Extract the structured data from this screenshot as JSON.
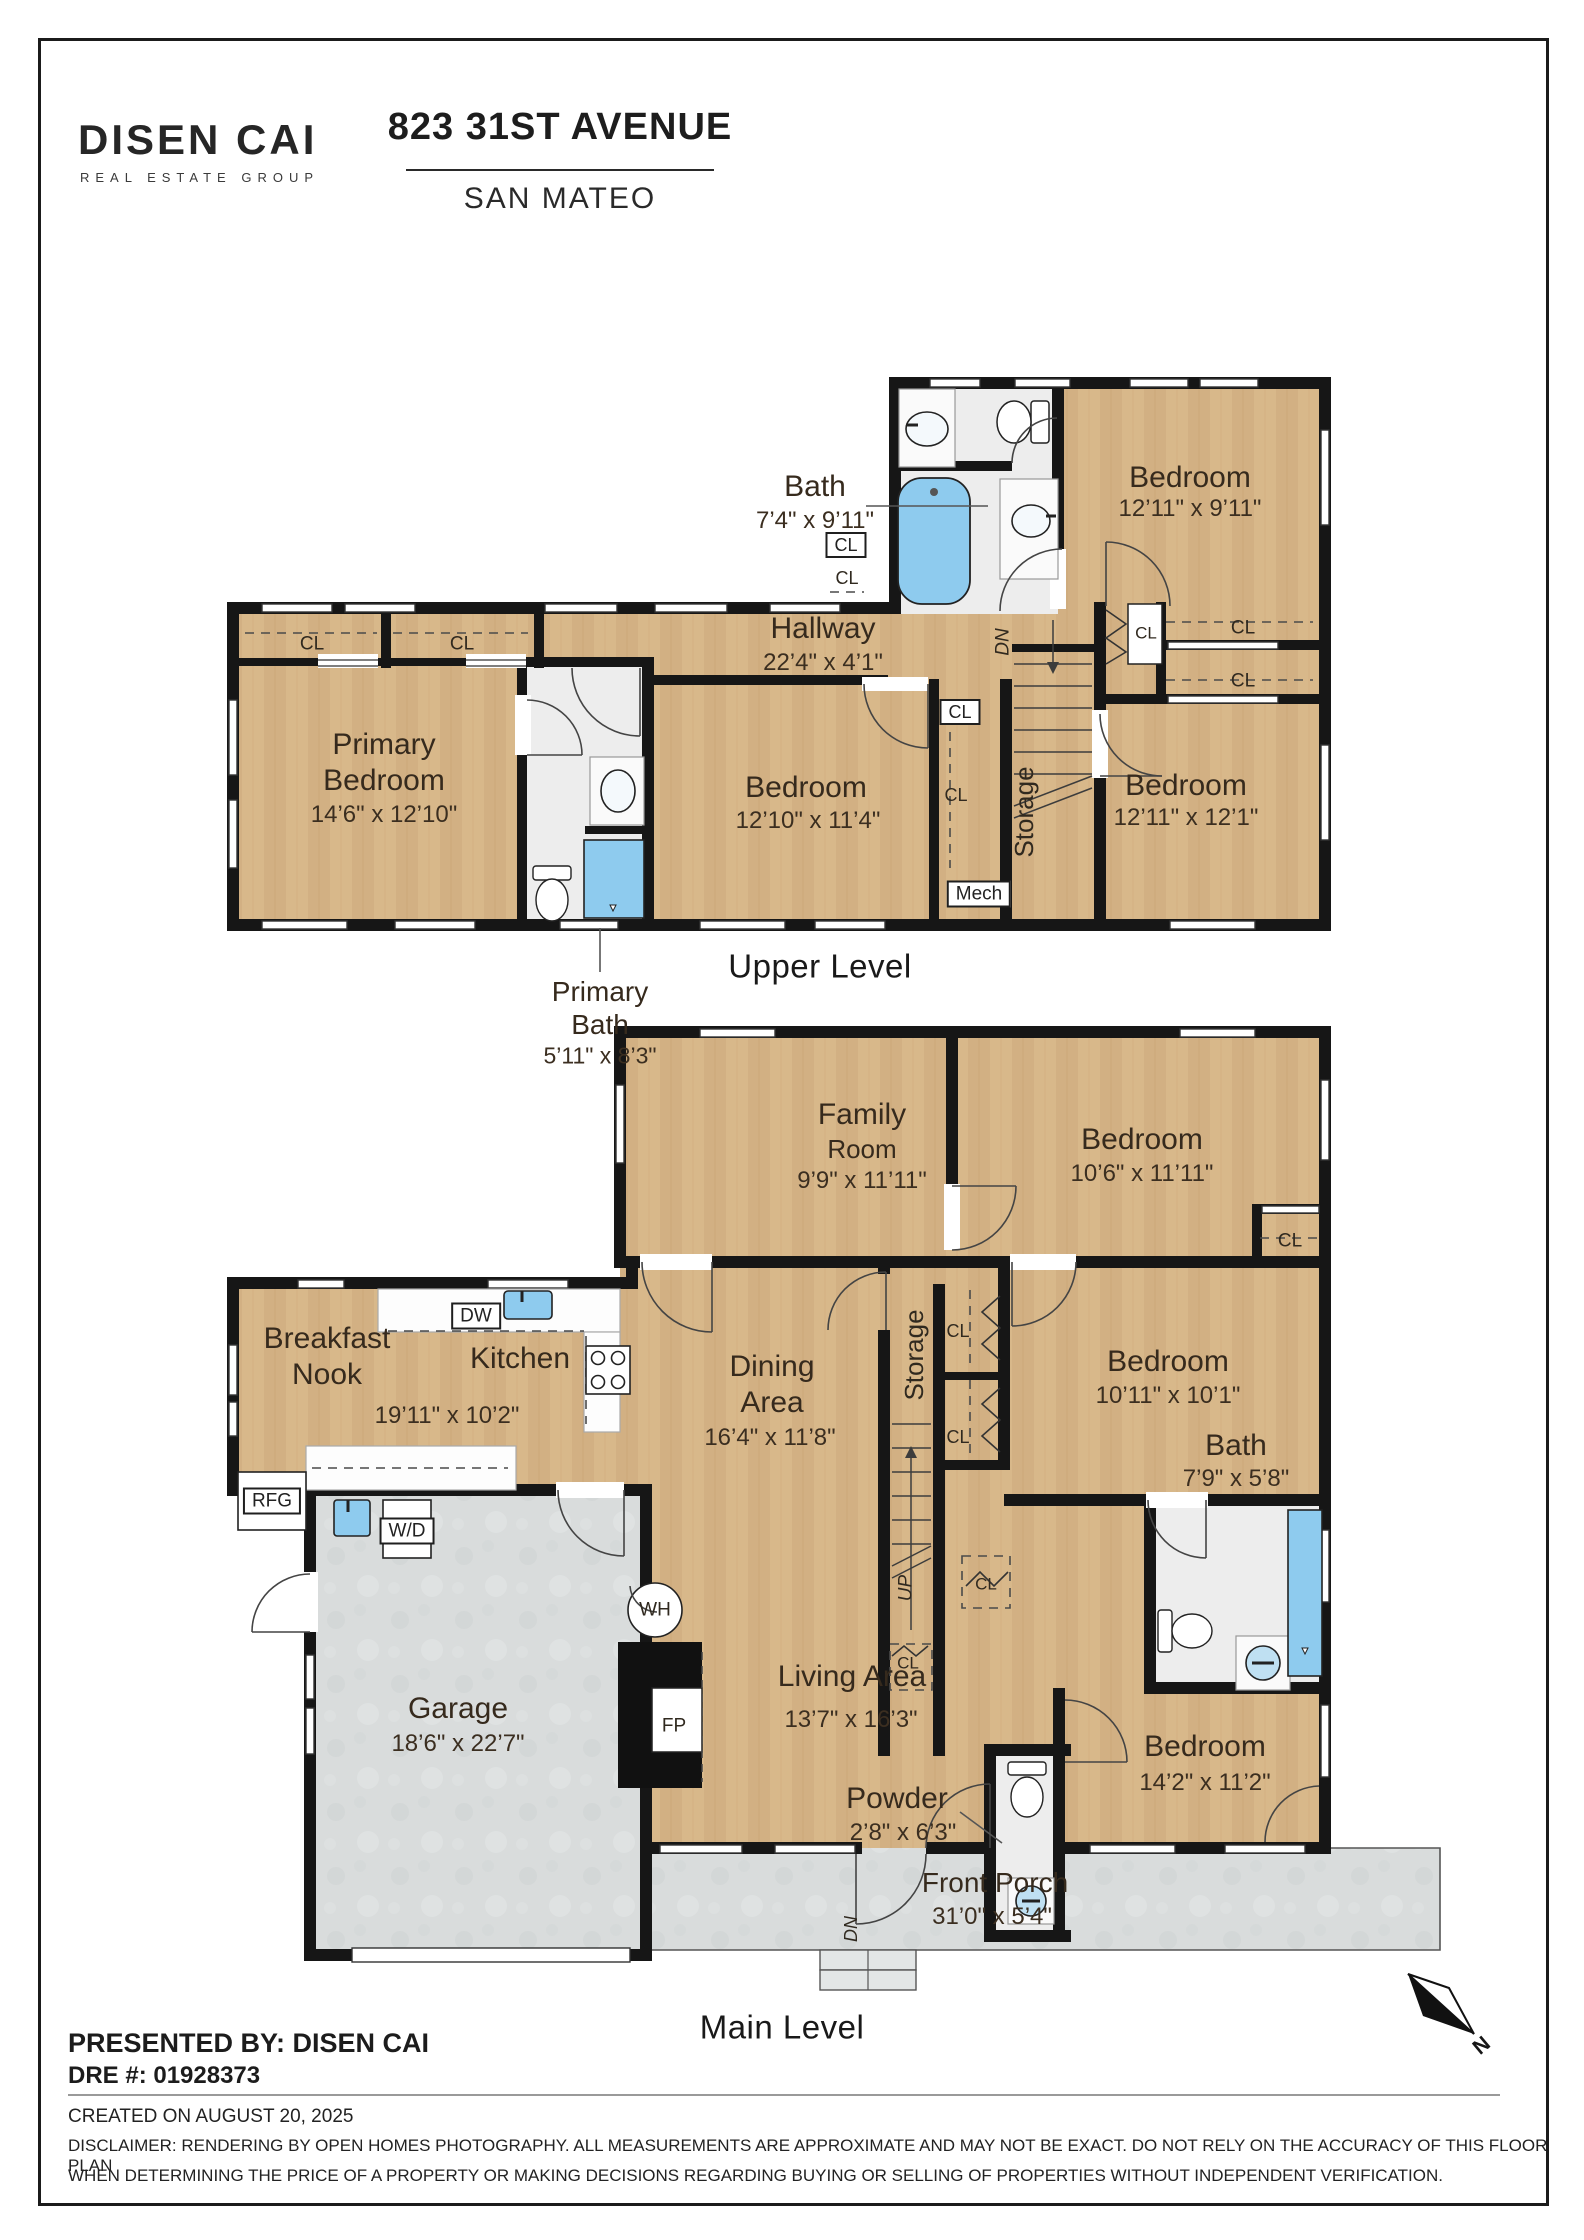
{
  "header": {
    "brand_name": "DISEN CAI",
    "brand_tagline": "REAL ESTATE GROUP",
    "address": "823 31ST AVENUE",
    "city": "SAN MATEO"
  },
  "footer": {
    "presented_by": "PRESENTED BY: DISEN CAI",
    "dre_number": "DRE #: 01928373",
    "created_on": "CREATED ON AUGUST 20, 2025",
    "disclaimer_line1": "DISCLAIMER: RENDERING BY OPEN HOMES PHOTOGRAPHY. ALL MEASUREMENTS ARE APPROXIMATE AND MAY NOT BE EXACT. DO NOT RELY ON THE ACCURACY OF THIS FLOOR PLAN",
    "disclaimer_line2": "WHEN DETERMINING THE PRICE OF A PROPERTY OR MAKING DECISIONS REGARDING BUYING OR SELLING OF PROPERTIES WITHOUT INDEPENDENT VERIFICATION."
  },
  "compass": {
    "north_label": "N"
  },
  "colors": {
    "wood": "#d8b88a",
    "bath_floor": "#ededed",
    "concrete": "#d9dcdc",
    "wall": "#161616",
    "fixture_blue": "#8ecbee",
    "label_text": "#362a1d"
  },
  "levels": [
    {
      "name": "Upper Level",
      "labels": [
        {
          "text": "Bath",
          "x": 815,
          "y": 487,
          "fs": 30,
          "kind": "room"
        },
        {
          "text": "7’4\" x 9’11\"",
          "x": 815,
          "y": 521,
          "fs": 24,
          "kind": "dims"
        },
        {
          "text": "Bedroom",
          "x": 1190,
          "y": 478,
          "fs": 30,
          "kind": "room"
        },
        {
          "text": "12’11\" x 9’11\"",
          "x": 1190,
          "y": 509,
          "fs": 24,
          "kind": "dims"
        },
        {
          "text": "Hallway",
          "x": 823,
          "y": 629,
          "fs": 30,
          "kind": "room"
        },
        {
          "text": "22’4\" x 4’1\"",
          "x": 823,
          "y": 663,
          "fs": 24,
          "kind": "dims"
        },
        {
          "text": "Primary",
          "x": 384,
          "y": 745,
          "fs": 30,
          "kind": "room"
        },
        {
          "text": "Bedroom",
          "x": 384,
          "y": 781,
          "fs": 30,
          "kind": "room"
        },
        {
          "text": "14’6\" x 12’10\"",
          "x": 384,
          "y": 815,
          "fs": 24,
          "kind": "dims"
        },
        {
          "text": "Bedroom",
          "x": 806,
          "y": 788,
          "fs": 30,
          "kind": "room"
        },
        {
          "text": "12’10\" x 11’4\"",
          "x": 808,
          "y": 821,
          "fs": 24,
          "kind": "dims"
        },
        {
          "text": "Bedroom",
          "x": 1186,
          "y": 786,
          "fs": 30,
          "kind": "room"
        },
        {
          "text": "12’11\" x 12’1\"",
          "x": 1186,
          "y": 818,
          "fs": 24,
          "kind": "dims"
        },
        {
          "text": "Primary",
          "x": 600,
          "y": 992,
          "fs": 28,
          "kind": "room"
        },
        {
          "text": "Bath",
          "x": 600,
          "y": 1025,
          "fs": 28,
          "kind": "room"
        },
        {
          "text": "5’11\" x 8’3\"",
          "x": 600,
          "y": 1056,
          "fs": 23,
          "kind": "dims"
        },
        {
          "text": "Upper Level",
          "x": 820,
          "y": 966,
          "fs": 33,
          "kind": "title"
        }
      ],
      "annotations": [
        {
          "text": "CL",
          "x": 312,
          "y": 644,
          "fs": 19
        },
        {
          "text": "CL",
          "x": 462,
          "y": 644,
          "fs": 19
        },
        {
          "text": "CL",
          "x": 846,
          "y": 545,
          "fs": 18,
          "box": true
        },
        {
          "text": "CL",
          "x": 847,
          "y": 578,
          "fs": 18
        },
        {
          "text": "CL",
          "x": 960,
          "y": 712,
          "fs": 18,
          "box": true
        },
        {
          "text": "CL",
          "x": 956,
          "y": 795,
          "fs": 18
        },
        {
          "text": "CL",
          "x": 1146,
          "y": 633,
          "fs": 17
        },
        {
          "text": "CL",
          "x": 1243,
          "y": 628,
          "fs": 19
        },
        {
          "text": "CL",
          "x": 1243,
          "y": 681,
          "fs": 19
        },
        {
          "text": "Mech",
          "x": 979,
          "y": 894,
          "fs": 19,
          "box": true
        },
        {
          "text": "DN",
          "x": 1003,
          "y": 642,
          "fs": 19,
          "rot": -90,
          "italic": true
        },
        {
          "text": "Storage",
          "x": 1024,
          "y": 812,
          "fs": 26,
          "rot": -90
        }
      ]
    },
    {
      "name": "Main Level",
      "labels": [
        {
          "text": "Family",
          "x": 862,
          "y": 1115,
          "fs": 30,
          "kind": "room"
        },
        {
          "text": "Room",
          "x": 862,
          "y": 1149,
          "fs": 26,
          "kind": "room"
        },
        {
          "text": "9’9\" x 11’11\"",
          "x": 862,
          "y": 1181,
          "fs": 24,
          "kind": "dims"
        },
        {
          "text": "Bedroom",
          "x": 1142,
          "y": 1140,
          "fs": 30,
          "kind": "room"
        },
        {
          "text": "10’6\" x 11’11\"",
          "x": 1142,
          "y": 1174,
          "fs": 24,
          "kind": "dims"
        },
        {
          "text": "Breakfast",
          "x": 327,
          "y": 1339,
          "fs": 30,
          "kind": "room"
        },
        {
          "text": "Nook",
          "x": 327,
          "y": 1375,
          "fs": 30,
          "kind": "room"
        },
        {
          "text": "Kitchen",
          "x": 520,
          "y": 1359,
          "fs": 30,
          "kind": "room"
        },
        {
          "text": "19’11\" x 10’2\"",
          "x": 447,
          "y": 1416,
          "fs": 24,
          "kind": "dims"
        },
        {
          "text": "Dining",
          "x": 772,
          "y": 1367,
          "fs": 30,
          "kind": "room"
        },
        {
          "text": "Area",
          "x": 772,
          "y": 1403,
          "fs": 30,
          "kind": "room"
        },
        {
          "text": "16’4\" x 11’8\"",
          "x": 770,
          "y": 1438,
          "fs": 24,
          "kind": "dims"
        },
        {
          "text": "Bedroom",
          "x": 1168,
          "y": 1362,
          "fs": 30,
          "kind": "room"
        },
        {
          "text": "10’11\" x 10’1\"",
          "x": 1168,
          "y": 1396,
          "fs": 24,
          "kind": "dims"
        },
        {
          "text": "Bath",
          "x": 1236,
          "y": 1446,
          "fs": 30,
          "kind": "room"
        },
        {
          "text": "7’9\" x 5’8\"",
          "x": 1236,
          "y": 1479,
          "fs": 24,
          "kind": "dims"
        },
        {
          "text": "Garage",
          "x": 458,
          "y": 1709,
          "fs": 30,
          "kind": "room"
        },
        {
          "text": "18’6\" x 22’7\"",
          "x": 458,
          "y": 1744,
          "fs": 24,
          "kind": "dims"
        },
        {
          "text": "Living Area",
          "x": 852,
          "y": 1677,
          "fs": 30,
          "kind": "room"
        },
        {
          "text": "13’7\" x 16’3\"",
          "x": 851,
          "y": 1720,
          "fs": 24,
          "kind": "dims"
        },
        {
          "text": "Powder",
          "x": 897,
          "y": 1799,
          "fs": 30,
          "kind": "room"
        },
        {
          "text": "2’8\" x 6’3\"",
          "x": 903,
          "y": 1833,
          "fs": 24,
          "kind": "dims"
        },
        {
          "text": "Bedroom",
          "x": 1205,
          "y": 1747,
          "fs": 30,
          "kind": "room"
        },
        {
          "text": "14’2\" x 11’2\"",
          "x": 1205,
          "y": 1783,
          "fs": 24,
          "kind": "dims"
        },
        {
          "text": "Front Porch",
          "x": 995,
          "y": 1883,
          "fs": 28,
          "kind": "room"
        },
        {
          "text": "31’0\" x 5’4\"",
          "x": 992,
          "y": 1917,
          "fs": 24,
          "kind": "dims"
        },
        {
          "text": "Main Level",
          "x": 782,
          "y": 2027,
          "fs": 33,
          "kind": "title"
        }
      ],
      "annotations": [
        {
          "text": "CL",
          "x": 1290,
          "y": 1241,
          "fs": 19
        },
        {
          "text": "DW",
          "x": 476,
          "y": 1316,
          "fs": 19,
          "box": true
        },
        {
          "text": "RFG",
          "x": 272,
          "y": 1501,
          "fs": 19,
          "box": true
        },
        {
          "text": "W/D",
          "x": 407,
          "y": 1531,
          "fs": 19,
          "box": true
        },
        {
          "text": "WH",
          "x": 655,
          "y": 1610,
          "fs": 19
        },
        {
          "text": "FP",
          "x": 674,
          "y": 1726,
          "fs": 19
        },
        {
          "text": "Storage",
          "x": 914,
          "y": 1355,
          "fs": 26,
          "rot": -90
        },
        {
          "text": "UP",
          "x": 906,
          "y": 1588,
          "fs": 19,
          "rot": -90,
          "italic": true
        },
        {
          "text": "CL",
          "x": 958,
          "y": 1331,
          "fs": 18
        },
        {
          "text": "CL",
          "x": 958,
          "y": 1437,
          "fs": 18
        },
        {
          "text": "CL",
          "x": 986,
          "y": 1584,
          "fs": 17
        },
        {
          "text": "CL",
          "x": 908,
          "y": 1663,
          "fs": 17
        },
        {
          "text": "DN",
          "x": 851,
          "y": 1929,
          "fs": 18,
          "rot": -90,
          "italic": true
        }
      ]
    }
  ]
}
